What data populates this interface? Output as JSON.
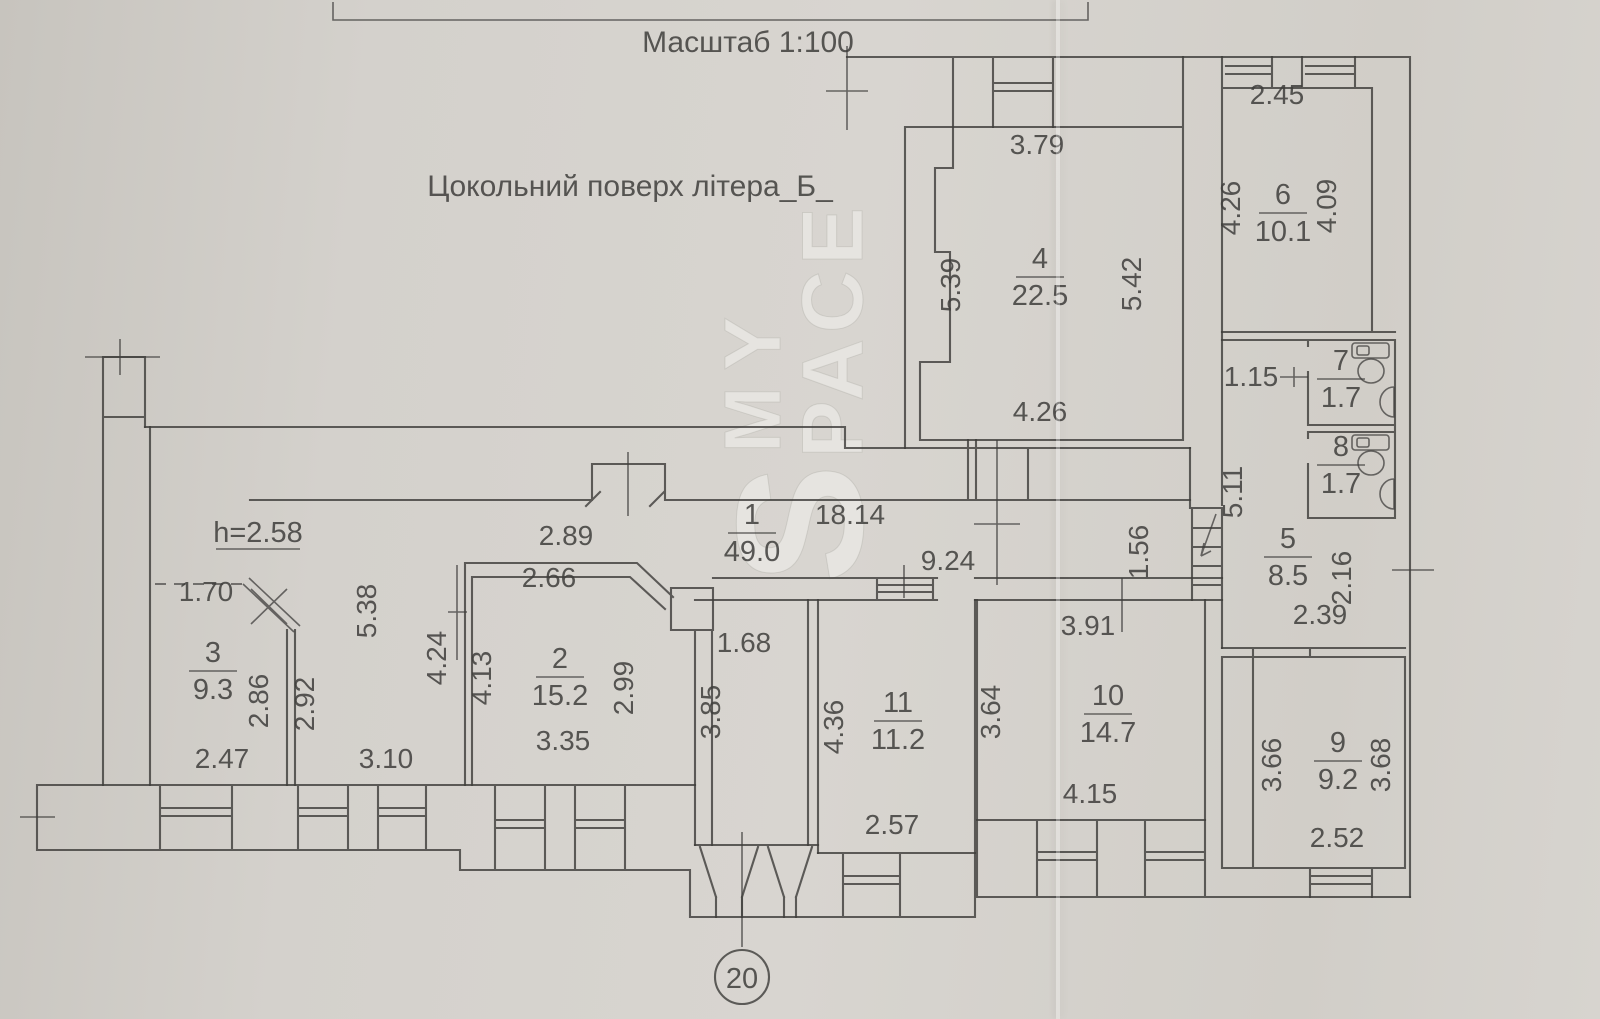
{
  "meta": {
    "scale_label": "Масштаб 1:100",
    "floor_label": "Цокольний поверх літера_Б_",
    "ceiling_height_note": "h=2.58",
    "axis_marker": "20",
    "watermark_line1": "MY",
    "watermark_big_letter": "S",
    "watermark_line2_rest": "PACE"
  },
  "colors": {
    "paper": "#d5d2cc",
    "ink": "#3f3e3c",
    "watermark": "#e8e6e2"
  },
  "rooms": [
    {
      "number": "1",
      "area": "49.0",
      "x": 752,
      "y": 524
    },
    {
      "number": "2",
      "area": "15.2",
      "x": 560,
      "y": 668
    },
    {
      "number": "3",
      "area": "9.3",
      "x": 213,
      "y": 662
    },
    {
      "number": "4",
      "area": "22.5",
      "x": 1040,
      "y": 268
    },
    {
      "number": "5",
      "area": "8.5",
      "x": 1288,
      "y": 548
    },
    {
      "number": "6",
      "area": "10.1",
      "x": 1283,
      "y": 204
    },
    {
      "number": "7",
      "area": "1.7",
      "x": 1341,
      "y": 370
    },
    {
      "number": "8",
      "area": "1.7",
      "x": 1341,
      "y": 456
    },
    {
      "number": "9",
      "area": "9.2",
      "x": 1338,
      "y": 752
    },
    {
      "number": "10",
      "area": "14.7",
      "x": 1108,
      "y": 705
    },
    {
      "number": "11",
      "area": "11.2",
      "x": 898,
      "y": 712
    }
  ],
  "dimensions": [
    {
      "t": "2.45",
      "x": 1277,
      "y": 104,
      "r": 0
    },
    {
      "t": "4.26",
      "x": 1240,
      "y": 208,
      "r": -90
    },
    {
      "t": "4.09",
      "x": 1336,
      "y": 206,
      "r": -90
    },
    {
      "t": "3.79",
      "x": 1037,
      "y": 154,
      "r": 0
    },
    {
      "t": "5.39",
      "x": 960,
      "y": 285,
      "r": -90
    },
    {
      "t": "5.42",
      "x": 1141,
      "y": 284,
      "r": -90
    },
    {
      "t": "4.26",
      "x": 1040,
      "y": 421,
      "r": 0
    },
    {
      "t": "1.15",
      "x": 1251,
      "y": 386,
      "r": 0
    },
    {
      "t": "5.11",
      "x": 1242,
      "y": 492,
      "r": -90
    },
    {
      "t": "2.16",
      "x": 1351,
      "y": 578,
      "r": -90
    },
    {
      "t": "2.39",
      "x": 1320,
      "y": 624,
      "r": 0
    },
    {
      "t": "1.56",
      "x": 1148,
      "y": 552,
      "r": -90
    },
    {
      "t": "18.14",
      "x": 850,
      "y": 524,
      "r": 0
    },
    {
      "t": "9.24",
      "x": 948,
      "y": 570,
      "r": 0
    },
    {
      "t": "3.91",
      "x": 1088,
      "y": 635,
      "r": 0
    },
    {
      "t": "3.64",
      "x": 1000,
      "y": 712,
      "r": -90
    },
    {
      "t": "4.15",
      "x": 1090,
      "y": 803,
      "r": 0
    },
    {
      "t": "2.57",
      "x": 892,
      "y": 834,
      "r": 0
    },
    {
      "t": "4.36",
      "x": 843,
      "y": 727,
      "r": -90
    },
    {
      "t": "1.68",
      "x": 744,
      "y": 652,
      "r": 0
    },
    {
      "t": "3.85",
      "x": 720,
      "y": 712,
      "r": -90
    },
    {
      "t": "2.99",
      "x": 633,
      "y": 688,
      "r": -90
    },
    {
      "t": "3.35",
      "x": 563,
      "y": 750,
      "r": 0
    },
    {
      "t": "2.66",
      "x": 549,
      "y": 587,
      "r": 0
    },
    {
      "t": "2.89",
      "x": 566,
      "y": 545,
      "r": 0
    },
    {
      "t": "4.13",
      "x": 491,
      "y": 678,
      "r": -90
    },
    {
      "t": "4.24",
      "x": 446,
      "y": 658,
      "r": -90
    },
    {
      "t": "5.38",
      "x": 376,
      "y": 611,
      "r": -90
    },
    {
      "t": "3.10",
      "x": 386,
      "y": 768,
      "r": 0
    },
    {
      "t": "2.47",
      "x": 222,
      "y": 768,
      "r": 0
    },
    {
      "t": "1.70",
      "x": 206,
      "y": 601,
      "r": 0
    },
    {
      "t": "2.86",
      "x": 268,
      "y": 701,
      "r": -90
    },
    {
      "t": "2.92",
      "x": 314,
      "y": 704,
      "r": -90
    },
    {
      "t": "3.66",
      "x": 1281,
      "y": 765,
      "r": -90
    },
    {
      "t": "3.68",
      "x": 1390,
      "y": 765,
      "r": -90
    },
    {
      "t": "2.52",
      "x": 1337,
      "y": 847,
      "r": 0
    }
  ]
}
